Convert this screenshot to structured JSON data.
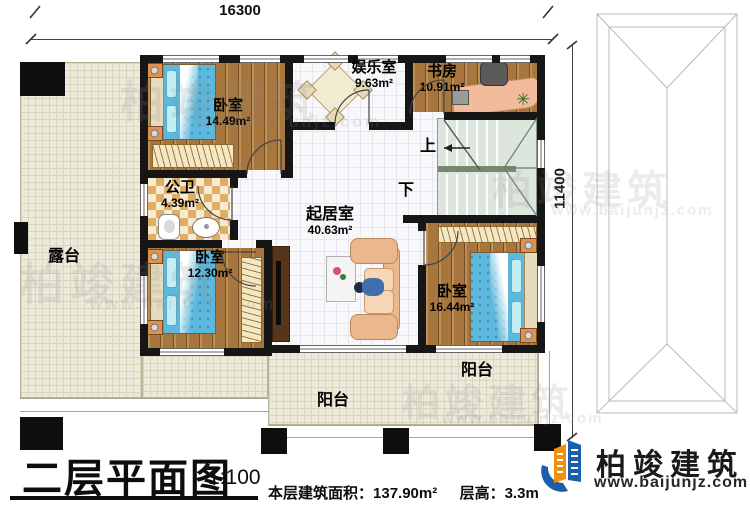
{
  "dimensions": {
    "top": "16300",
    "right": "11400"
  },
  "rooms": [
    {
      "name": "卧室",
      "area": "14.49m²"
    },
    {
      "name": "公卫",
      "area": "4.39m²"
    },
    {
      "name": "卧室",
      "area": "12.30m²"
    },
    {
      "name": "娱乐室",
      "area": "9.63m²"
    },
    {
      "name": "书房",
      "area": "10.91m²"
    },
    {
      "name": "起居室",
      "area": "40.63m²"
    },
    {
      "name": "卧室",
      "area": "16.44m²"
    },
    {
      "name": "露台"
    },
    {
      "name": "阳台"
    },
    {
      "name": "阳台"
    }
  ],
  "stairs": {
    "up": "上",
    "down": "下"
  },
  "title": {
    "text": "二层平面图",
    "scale": "1:100"
  },
  "stats": {
    "area_label": "本层建筑面积：",
    "area_value": "137.90m²",
    "height_label": "层高：",
    "height_value": "3.3m"
  },
  "brand": {
    "name": "柏竣建筑",
    "url": "www.baijunjz.com"
  },
  "watermark": {
    "name": "柏竣建筑",
    "url": "www.baijunjz.com"
  },
  "colors": {
    "brand_blue": "#1b5fa8",
    "brand_orange": "#f0900f"
  }
}
